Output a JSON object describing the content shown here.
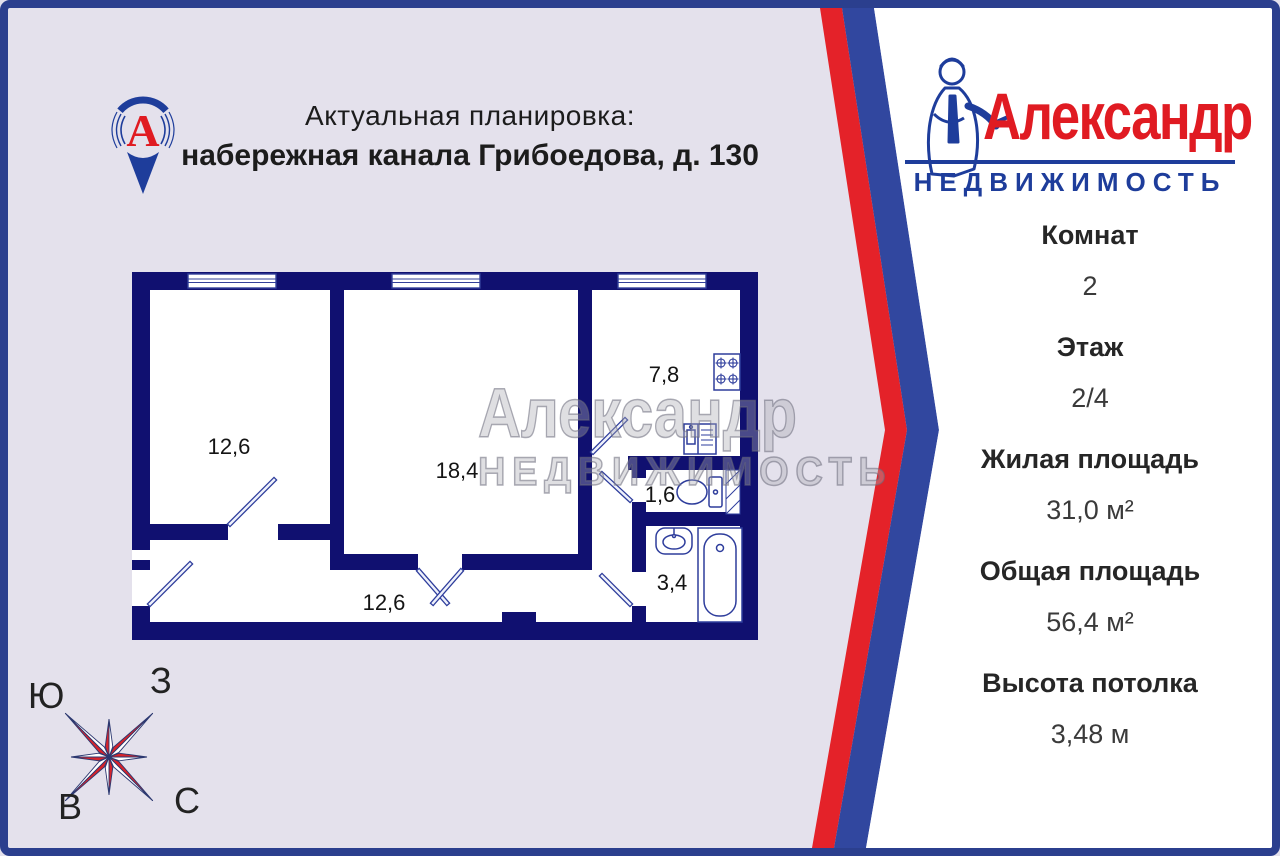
{
  "colors": {
    "background_left": "#e4e1ec",
    "panel_white": "#ffffff",
    "border_navy": "#2b3f8e",
    "stripe_red": "#e42229",
    "stripe_blue": "#31479f",
    "wall_navy": "#101070",
    "brand_red": "#e01b22",
    "brand_blue": "#1e3d9b",
    "compass_red": "#d6242b"
  },
  "header": {
    "line1": "Актуальная планировка:",
    "line2": "набережная канала Грибоедова, д. 130"
  },
  "brand": {
    "pin_letter": "А",
    "name": "Александр",
    "subtitle": "НЕДВИЖИМОСТЬ"
  },
  "floorplan": {
    "watermark": {
      "line1": "Александр",
      "line2": "НЕДВИЖИМОСТЬ"
    },
    "rooms": {
      "room1": "12,6",
      "living": "18,4",
      "kitchen": "7,8",
      "wc": "1,6",
      "bath": "3,4",
      "hall": "12,6"
    }
  },
  "compass": {
    "south": "Ю",
    "west": "З",
    "east": "В",
    "north": "С"
  },
  "details": [
    {
      "label": "Комнат",
      "value": "2"
    },
    {
      "label": "Этаж",
      "value": "2/4"
    },
    {
      "label": "Жилая площадь",
      "value": "31,0 м²"
    },
    {
      "label": "Общая площадь",
      "value": "56,4 м²"
    },
    {
      "label": "Высота потолка",
      "value": "3,48 м"
    }
  ]
}
